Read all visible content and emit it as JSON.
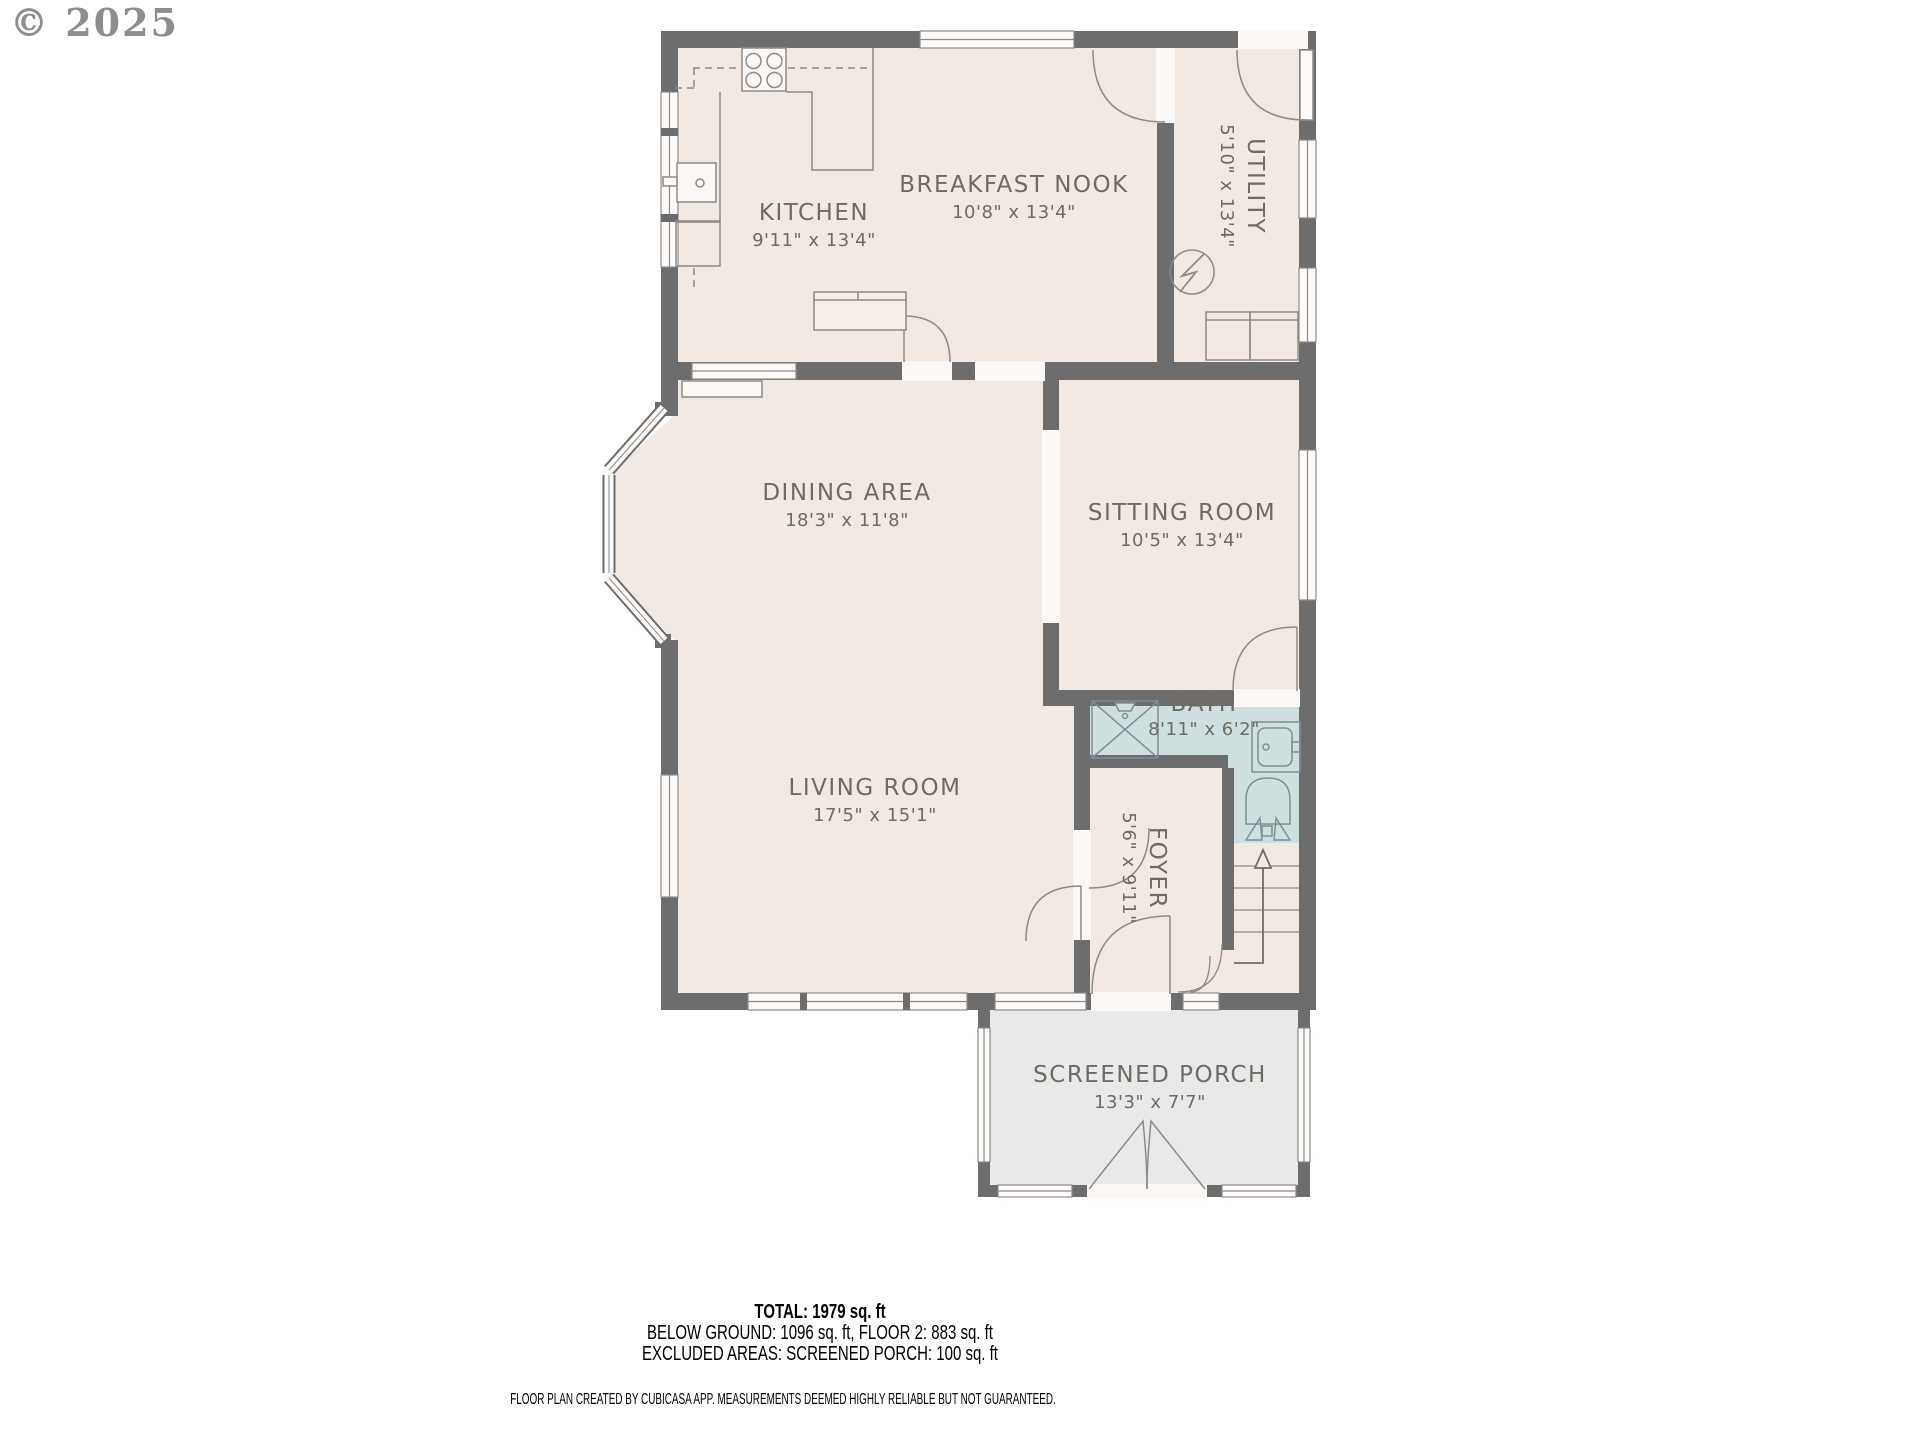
{
  "watermark": "© 2025",
  "plan": {
    "rooms": [
      {
        "id": "kitchen",
        "name": "KITCHEN",
        "dims": "9'11\" x 13'4\""
      },
      {
        "id": "breakfast-nook",
        "name": "BREAKFAST NOOK",
        "dims": "10'8\" x 13'4\""
      },
      {
        "id": "utility",
        "name": "UTILITY",
        "dims": "5'10\" x 13'4\""
      },
      {
        "id": "dining-area",
        "name": "DINING AREA",
        "dims": "18'3\" x 11'8\""
      },
      {
        "id": "sitting-room",
        "name": "SITTING ROOM",
        "dims": "10'5\" x 13'4\""
      },
      {
        "id": "bath",
        "name": "BATH",
        "dims": "8'11\" x 6'2\""
      },
      {
        "id": "living-room",
        "name": "LIVING ROOM",
        "dims": "17'5\" x 15'1\""
      },
      {
        "id": "foyer",
        "name": "FOYER",
        "dims": "5'6\" x 9'11\""
      },
      {
        "id": "screened-porch",
        "name": "SCREENED PORCH",
        "dims": "13'3\" x 7'7\""
      }
    ]
  },
  "summary": {
    "total": "TOTAL: 1979 sq. ft",
    "floors": "BELOW GROUND: 1096 sq. ft, FLOOR 2: 883 sq. ft",
    "excluded": "EXCLUDED AREAS: SCREENED PORCH: 100 sq. ft"
  },
  "footer": "FLOOR PLAN CREATED BY CUBICASA APP. MEASUREMENTS DEEMED HIGHLY RELIABLE BUT NOT GUARANTEED.",
  "colors": {
    "wall": "#6d6d6d",
    "floor": "#f2e9e3",
    "bath": "#cfdfe0",
    "porch": "#e9e9e9",
    "label": "#6f6a64",
    "window": "#fdfaf7"
  }
}
